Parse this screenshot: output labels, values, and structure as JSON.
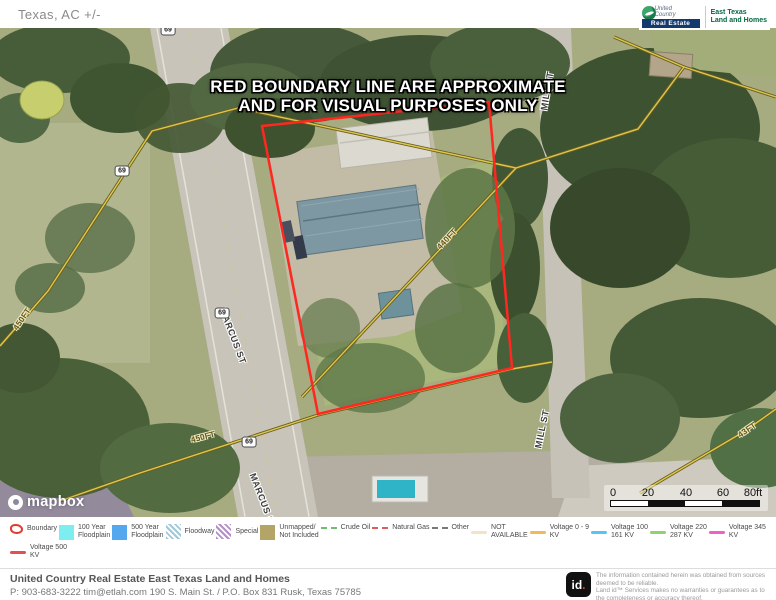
{
  "header": {
    "title": "Texas,  AC +/-"
  },
  "brand": {
    "uc_top": "United",
    "uc_mid": "Country",
    "uc_banner": "Real Estate",
    "division_line1": "East Texas",
    "division_line2": "Land and Homes"
  },
  "map": {
    "notice_line1": "RED BOUNDARY LINE ARE APPROXIMATE",
    "notice_line2": "AND FOR VISUAL PURPOSES ONLY",
    "route_shield": "69",
    "streets": [
      "MILL ST",
      "MILL ST",
      "MARCUS ST",
      "MARCUS ST"
    ],
    "distances": [
      "450FT",
      "440FT",
      "450FT",
      "43FT"
    ],
    "attribution": "mapbox",
    "scale_ticks": [
      "0",
      "20",
      "40",
      "60",
      "80ft"
    ],
    "boundary_color": "#ff2720"
  },
  "legend": {
    "rows": [
      [
        {
          "label": "Boundary",
          "type": "boundary",
          "color": "#e03c31"
        },
        {
          "label": "100 Year\nFloodplain",
          "type": "fill",
          "color": "#7deef0"
        },
        {
          "label": "500 Year\nFloodplain",
          "type": "fill",
          "color": "#55a8ee"
        },
        {
          "label": "Floodway",
          "type": "hatch",
          "color": "#9fc8d8"
        },
        {
          "label": "Special",
          "type": "hatch",
          "color": "#b48ec8"
        },
        {
          "label": "Unmapped/\nNot Included",
          "type": "fill",
          "color": "#b3a468"
        },
        {
          "label": "Crude Oil",
          "type": "dash",
          "color": "#6fbf73"
        },
        {
          "label": "Natural Gas",
          "type": "dash",
          "color": "#d95f5f"
        },
        {
          "label": "Other",
          "type": "dash",
          "color": "#777777"
        },
        {
          "label": "NOT\nAVAILABLE",
          "type": "line",
          "color": "#f2e3c4"
        },
        {
          "label": "Voltage 0 - 9\nKV",
          "type": "line",
          "color": "#f0b95a"
        },
        {
          "label": "Voltage 100\n161 KV",
          "type": "line",
          "color": "#5ac4f0"
        },
        {
          "label": "Voltage 220\n287 KV",
          "type": "line",
          "color": "#90d170"
        },
        {
          "label": "Voltage 345\nKV",
          "type": "line",
          "color": "#ef62c3"
        }
      ],
      [
        {
          "label": "Voltage 500\nKV",
          "type": "line",
          "color": "#e05252"
        }
      ]
    ]
  },
  "footer": {
    "company": "United Country Real Estate East Texas Land and Homes",
    "phone": "P: 903-683-3222",
    "email": "tim@etlah.com",
    "address": "190 S. Main St. / P.O. Box 831 Rusk, Texas 75785",
    "logo_text": "id",
    "logo_dot": ".",
    "disclaimer": "The information contained herein was obtained from sources deemed to be reliable.\nLand id™ Services makes no warranties or guarantees as to the completeness or accuracy thereof."
  }
}
